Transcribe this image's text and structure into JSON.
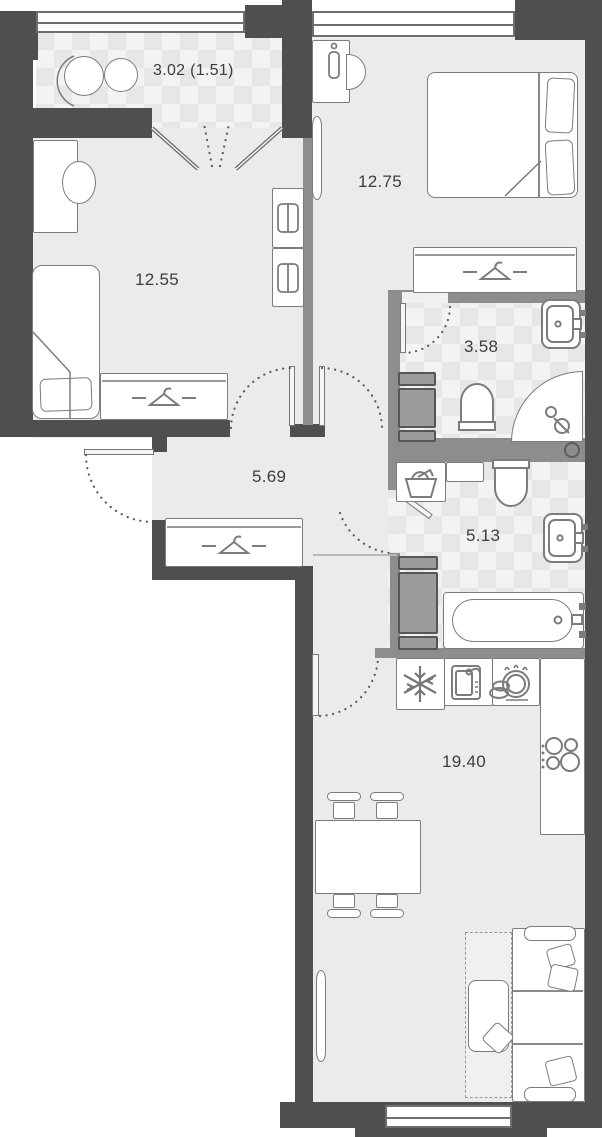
{
  "plan": {
    "title": "apartment floor plan",
    "rooms": [
      {
        "id": "balcony",
        "area_label": "3.02 (1.51)",
        "furniture": [
          "round-chair",
          "round-table"
        ]
      },
      {
        "id": "bedroom-secondary",
        "area_label": "12.55",
        "furniture": [
          "desk",
          "desk-chair",
          "single-bed",
          "wardrobe",
          "dresser",
          "dresser"
        ]
      },
      {
        "id": "bedroom-master",
        "area_label": "12.75",
        "furniture": [
          "desk",
          "desk-chair",
          "tv",
          "double-bed",
          "wardrobe"
        ]
      },
      {
        "id": "bathroom-ensuite",
        "area_label": "3.58",
        "furniture": [
          "sink",
          "toilet",
          "corner-shower",
          "cabinet"
        ]
      },
      {
        "id": "hallway",
        "area_label": "5.69",
        "furniture": [
          "wardrobe"
        ]
      },
      {
        "id": "bathroom-main",
        "area_label": "5.13",
        "furniture": [
          "laundry-basket",
          "toilet",
          "sink",
          "washing-machine",
          "bathtub"
        ]
      },
      {
        "id": "kitchen-living",
        "area_label": "19.40",
        "furniture": [
          "fridge",
          "kitchen-sink",
          "dishwasher",
          "stove",
          "dining-table",
          "stools",
          "corner-sofa",
          "tv"
        ]
      }
    ],
    "icons": {
      "wardrobe": "hanger-icon",
      "fridge": "snowflake-icon",
      "dishwasher": "dishes-icon",
      "stove": "burners-icon",
      "laundry": "laundry-basket-icon"
    },
    "colors": {
      "wall_exterior": "#4f4f4f",
      "wall_interior": "#8d8d8d",
      "floor": "#ebebeb",
      "tile": "#f3f3f3",
      "furniture_outline": "#7c7c7c",
      "appliance_fill": "#9c9c9c",
      "label_text": "#3d3d3d",
      "background": "#ffffff"
    }
  }
}
